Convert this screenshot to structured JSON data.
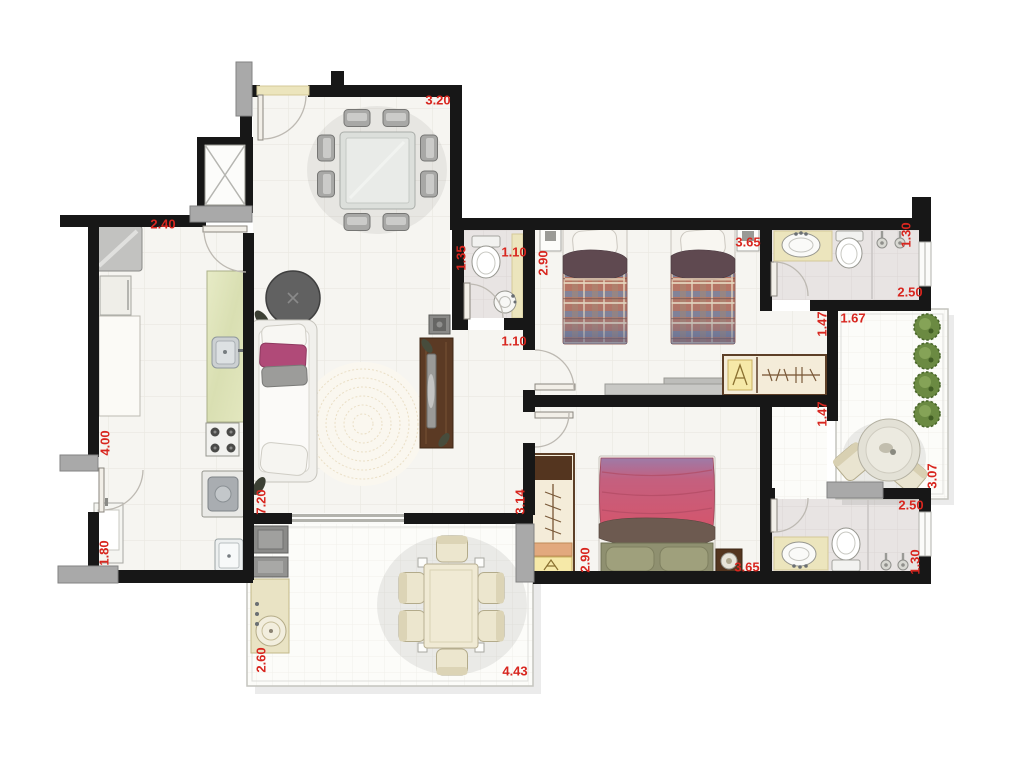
{
  "plan": {
    "type": "apartment-floor-plan",
    "colors": {
      "wall": "#171717",
      "column": "#a9a9a9",
      "dimension_text": "#d8261f",
      "background": "#ffffff"
    },
    "dimensions": [
      {
        "text": "3.20",
        "x": 438,
        "y": 100,
        "vertical": false
      },
      {
        "text": "2.40",
        "x": 163,
        "y": 224,
        "vertical": false
      },
      {
        "text": "4.00",
        "x": 105,
        "y": 443,
        "vertical": true
      },
      {
        "text": "1.80",
        "x": 104,
        "y": 553,
        "vertical": true
      },
      {
        "text": "7.20",
        "x": 261,
        "y": 502,
        "vertical": true
      },
      {
        "text": "2.60",
        "x": 261,
        "y": 660,
        "vertical": true
      },
      {
        "text": "4.43",
        "x": 515,
        "y": 671,
        "vertical": false
      },
      {
        "text": "3.14",
        "x": 520,
        "y": 502,
        "vertical": true
      },
      {
        "text": "1.35",
        "x": 461,
        "y": 258,
        "vertical": true
      },
      {
        "text": "1.10",
        "x": 514,
        "y": 252,
        "vertical": false
      },
      {
        "text": "1.10",
        "x": 514,
        "y": 341,
        "vertical": false
      },
      {
        "text": "2.90",
        "x": 543,
        "y": 263,
        "vertical": true
      },
      {
        "text": "3.65",
        "x": 748,
        "y": 242,
        "vertical": false
      },
      {
        "text": "1.30",
        "x": 906,
        "y": 235,
        "vertical": true
      },
      {
        "text": "2.50",
        "x": 910,
        "y": 292,
        "vertical": false
      },
      {
        "text": "1.47",
        "x": 822,
        "y": 324,
        "vertical": true
      },
      {
        "text": "1.67",
        "x": 853,
        "y": 318,
        "vertical": false
      },
      {
        "text": "1.47",
        "x": 822,
        "y": 414,
        "vertical": true
      },
      {
        "text": "3.07",
        "x": 932,
        "y": 476,
        "vertical": true
      },
      {
        "text": "2.90",
        "x": 585,
        "y": 560,
        "vertical": true
      },
      {
        "text": "3.65",
        "x": 747,
        "y": 567,
        "vertical": false
      },
      {
        "text": "2.50",
        "x": 911,
        "y": 505,
        "vertical": false
      },
      {
        "text": "1.30",
        "x": 915,
        "y": 562,
        "vertical": true
      }
    ]
  }
}
